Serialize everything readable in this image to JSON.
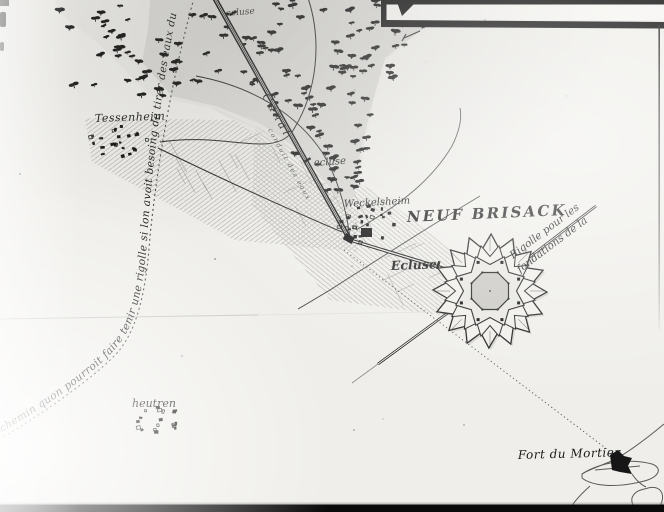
{
  "map": {
    "city_label": "NEUF BRISACK",
    "villages": {
      "tessenheim": "Tessenheim",
      "weckelsheim": "Weckelsheim",
      "heutren": "heutren"
    },
    "fort_du_mortier_label": "Fort du Mortier",
    "canal_label": "Canal",
    "canal_script_label": "conduit des eaux",
    "lock_labels": {
      "upper": "ecluse",
      "middle": "ecluse",
      "lower": "Ecluse"
    },
    "chemin_annotation": "chemin quon pourroit faire tenir une rigolle si lon avoit besoing de tirer des eaux du rhin",
    "rigolle_annotation_line1": "Rigolle pour les",
    "rigolle_annotation_line2": "fondations de la",
    "colors": {
      "ink": "#1a1a1a",
      "paper": "#efeeea"
    }
  }
}
